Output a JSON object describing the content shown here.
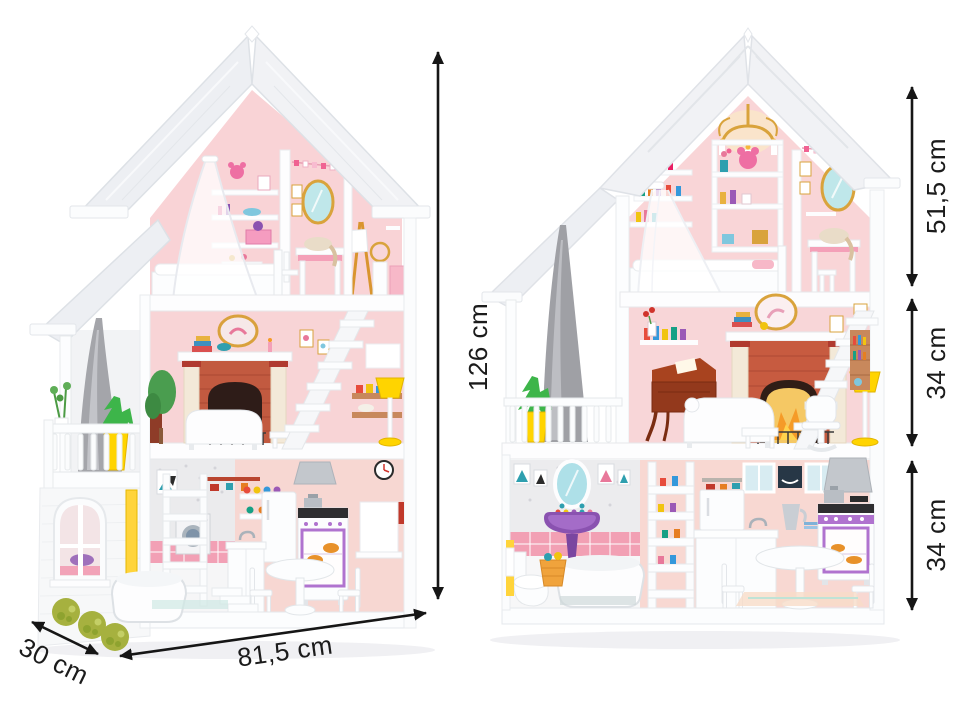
{
  "annotations": {
    "left_house": {
      "height": "126 cm",
      "width": "81,5 cm",
      "depth": "30 cm"
    },
    "right_house": {
      "floor_top": "51,5 cm",
      "floor_middle": "34 cm",
      "floor_ground": "34 cm"
    }
  },
  "palette": {
    "background": "#ffffff",
    "annotation_black": "#161616",
    "roof_white": "#f0f1f4",
    "wall_pink": "#f9d5d7",
    "tile_pink": "#f2a0b4",
    "accent_yellow": "#ffd400",
    "brick_red": "#c25a40",
    "curtain_grey": "#a2a3a8",
    "plant_green": "#3db54a",
    "bush_green": "#a6b13f",
    "sink_purple": "#8a52b0",
    "stove_purple": "#b073cf",
    "mirror_blue": "#aee0e8",
    "wood_brown": "#93391c",
    "gold": "#d9a33c"
  }
}
